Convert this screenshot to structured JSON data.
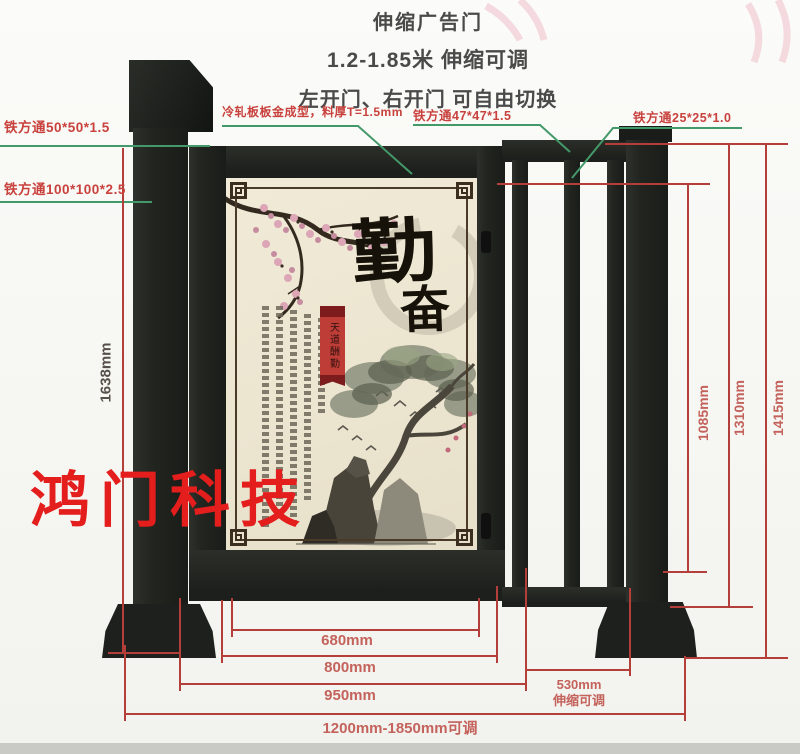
{
  "header": {
    "title": "伸缩广告门",
    "subtitle": "1.2-1.85米 伸缩可调",
    "subtitle2": "左开门、右开门 可自由切换"
  },
  "callouts": {
    "tube50": "铁方通50*50*1.5",
    "tube100": "铁方通100*100*2.5",
    "cold_plate": "冷轧板板金成型，料厚T=1.5mm",
    "tube47": "铁方通47*47*1.5",
    "tube25": "铁方通25*25*1.0"
  },
  "dims": {
    "left_height": "1638mm",
    "right": [
      "1085mm",
      "1310mm",
      "1415mm"
    ],
    "bottom": [
      "680mm",
      "800mm",
      "950mm",
      "1200mm-1850mm可调"
    ],
    "telescopic_value": "530mm",
    "telescopic_note": "伸缩可调"
  },
  "poster": {
    "char_main": "勤",
    "char_sub": "奋",
    "ribbon_text": "天道酬勤"
  },
  "watermark": "鸿门科技",
  "colors": {
    "dim_line": "#b43e3a",
    "leader_line": "#44996a",
    "label_red": "#c9413d",
    "dim_text": "#c4625c",
    "watermark_red": "#e41d1d",
    "metal_dark": "#20231f",
    "poster_bg": "#ede6d2"
  }
}
